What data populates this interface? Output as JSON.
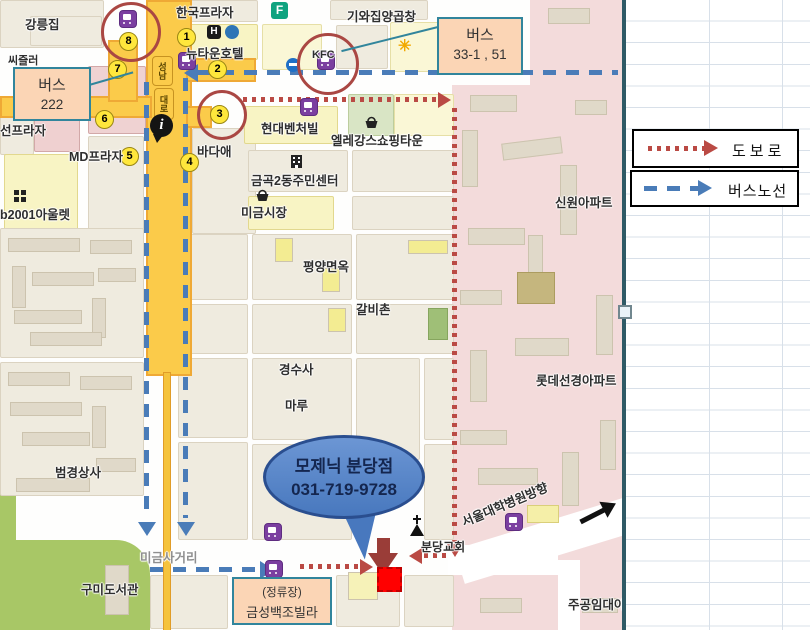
{
  "legend": {
    "walk_label": "도보로",
    "bus_label": "버스노선"
  },
  "callouts": {
    "bus222": {
      "title": "버스",
      "value": "222"
    },
    "bus33": {
      "title": "버스",
      "value": "33-1 , 51"
    },
    "stop": {
      "line1": "(정류장)",
      "line2": "금성백조빌라"
    },
    "bubble": {
      "line1": "모제닉 분당점",
      "line2": "031-719-9728"
    }
  },
  "stops": [
    "1",
    "2",
    "3",
    "4",
    "5",
    "6",
    "7",
    "8"
  ],
  "roads": {
    "pill1": "성남",
    "pill2": "대로"
  },
  "icons": {
    "hotel": "H",
    "store": "F"
  },
  "places": {
    "gangneungjip": "강릉집",
    "sizzler": "씨즐러",
    "hanguk_plaza": "한국프라자",
    "newtown_hotel": "뉴타운호텔",
    "giwajip": "기와집양곱창",
    "kfc": "KFC",
    "seon_plaza": "선프라자",
    "md_plaza": "MD프라자",
    "outlet2001": "b2001아울렛",
    "badaae": "바다애",
    "hyundai_venture": "현대벤처빌",
    "elegance": "엘레강스쇼핑타운",
    "geumgok_center": "금곡2동주민센터",
    "migeum_market": "미금시장",
    "shinwon_apt": "신원아파트",
    "pyongyang": "평양면옥",
    "galbichon": "갈비촌",
    "gyeongsusa": "경수사",
    "maru": "마루",
    "lotte_apt": "롯데선경아파트",
    "beomgyeong": "범경상사",
    "gumi_library": "구미도서관",
    "migeum_crossroad": "미금사거리",
    "bundang_church": "분당교회",
    "seoul_hosp_dir": "서울대학병원방향",
    "jugong": "주공임대아"
  },
  "colors": {
    "walk_route": "#BA4A44",
    "bus_route": "#4A7CB8",
    "callout_border": "#31859C",
    "callout_fill": "#FBD5B5",
    "bubble_fill": "#4878BE",
    "marker": "#FF0000",
    "block_arrow": "#9A3D38"
  }
}
